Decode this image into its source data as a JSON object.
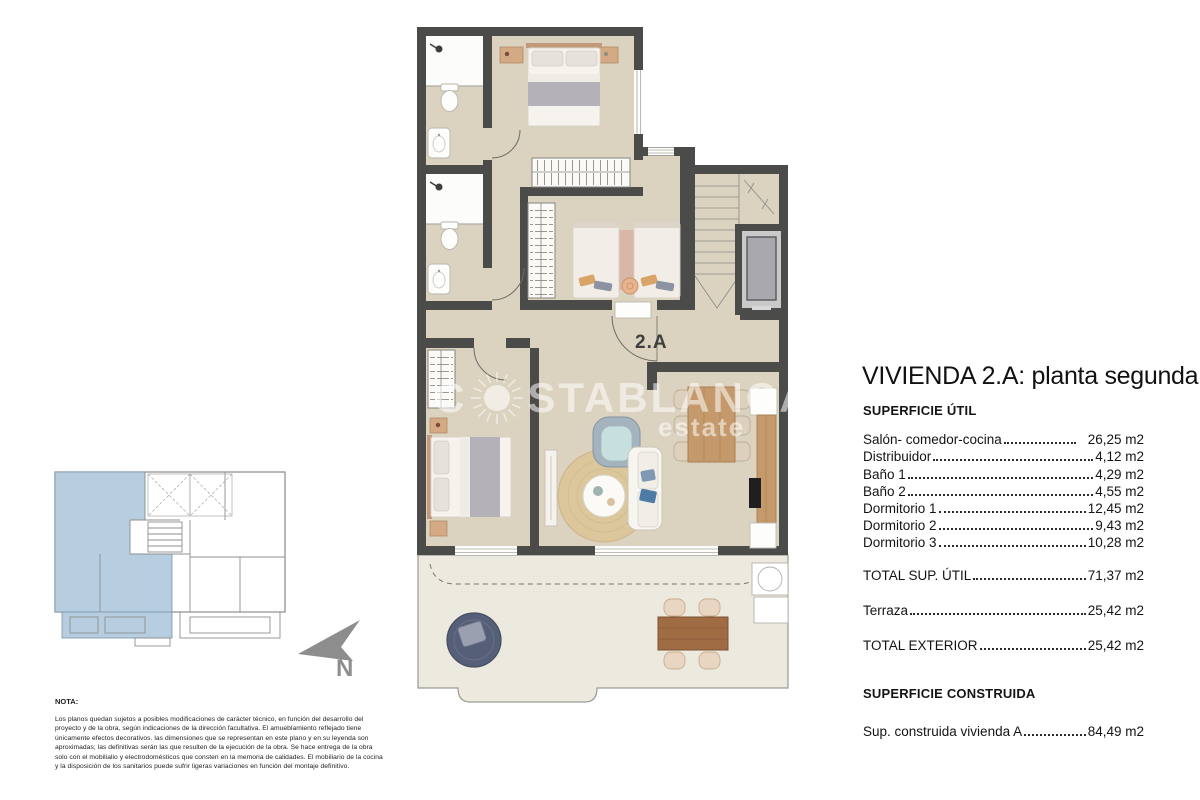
{
  "plan": {
    "unit_label": "2.A",
    "watermark": {
      "part1": "C",
      "part2": "STABLANCA",
      "line2": "estate"
    }
  },
  "north": {
    "label": "N"
  },
  "specs": {
    "title": "VIVIENDA 2.A: planta segunda",
    "section1_header": "SUPERFICIE ÚTIL",
    "rows": [
      {
        "label": "Salón- comedor-cocina",
        "value": "26,25 m2"
      },
      {
        "label": "Distribuidor",
        "value": "4,12 m2"
      },
      {
        "label": "Baño 1",
        "value": "4,29 m2"
      },
      {
        "label": "Baño 2",
        "value": "4,55 m2"
      },
      {
        "label": "Dormitorio 1",
        "value": "12,45 m2"
      },
      {
        "label": "Dormitorio 2",
        "value": "9,43 m2"
      },
      {
        "label": "Dormitorio 3",
        "value": "10,28 m2"
      }
    ],
    "total_util": {
      "label": "TOTAL SUP. ÚTIL",
      "value": "71,37 m2"
    },
    "terraza": {
      "label": "Terraza",
      "value": "25,42 m2"
    },
    "total_exterior": {
      "label": "TOTAL EXTERIOR",
      "value": "25,42 m2"
    },
    "section2_header": "SUPERFICIE CONSTRUIDA",
    "constructed": {
      "label": "Sup. construida vivienda A",
      "value": "84,49 m2"
    }
  },
  "nota": {
    "header": "NOTA:",
    "body": "Los planos quedan sujetos a posibles modificaciones de carácter técnico, en función del desarrollo del proyecto y de la obra, según indicaciones de la dirección facultativa. El amueblamiento reflejado tiene únicamente efectos decorativos. las dimensiones que se representan en este plano y en su leyenda son aproximadas; las definitivas serán las que resulten de la ejecución de la obra. Se hace entrega de la obra solo con el mobilialio y electrodomésticos que consten en la memoria de calidades. El mobiliario de la cocina y la disposición de los sanitarios puede sufrir ligeras variaciones en función del montaje definitivo."
  },
  "colors": {
    "wall": "#4b4b4a",
    "floor": "#dbd3bf",
    "terrace_floor": "#eceade",
    "keyplan_highlight": "#b6cedf",
    "north_gray": "#8d8d8d",
    "wood": "#c49a6c",
    "dark_wood": "#9a6b44",
    "navy": "#565f78",
    "text": "#161616"
  }
}
